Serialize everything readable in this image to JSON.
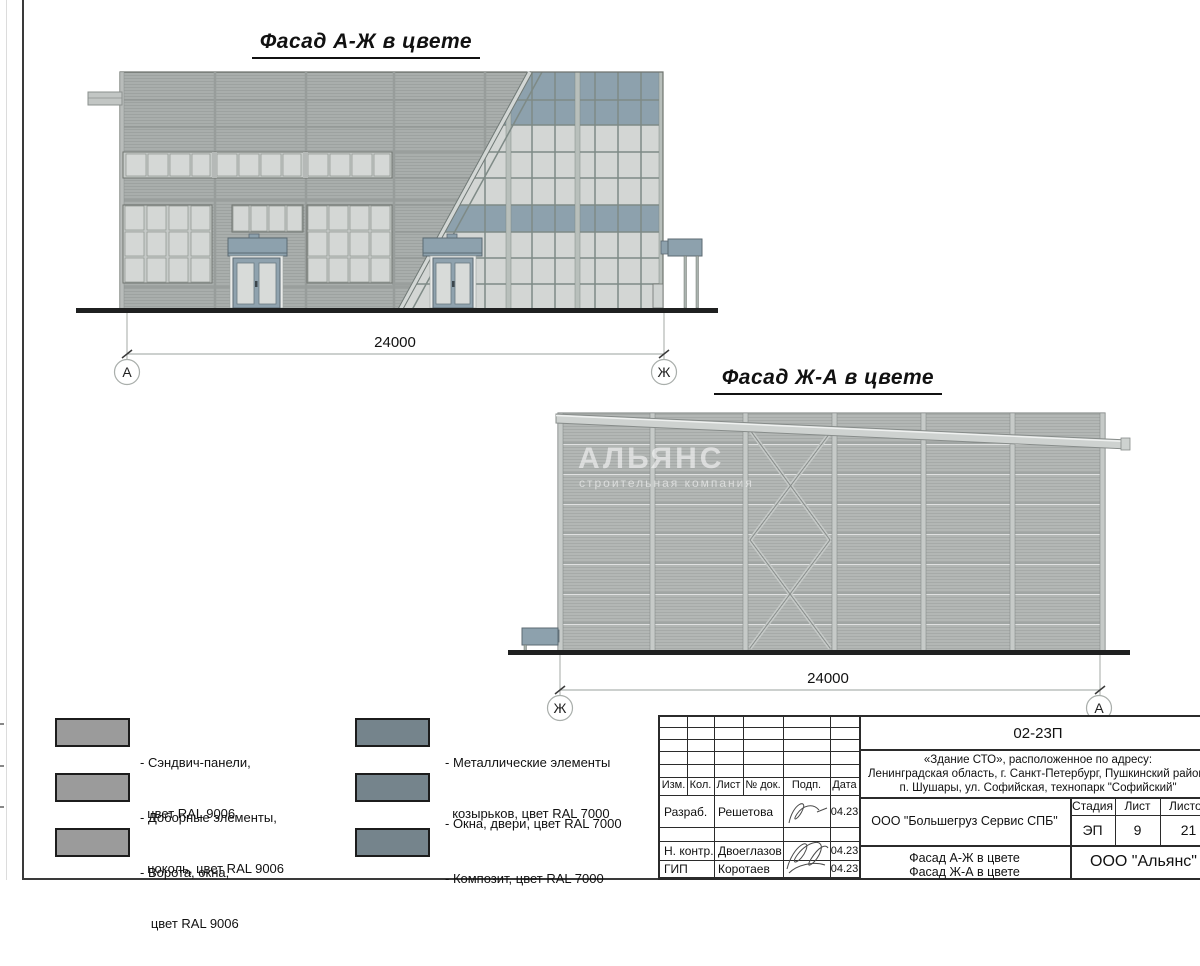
{
  "titles": {
    "facade_aj": "Фасад А-Ж в цвете",
    "facade_ja": "Фасад Ж-А в цвете"
  },
  "facade_aj": {
    "dim": "24000",
    "axis_left": "А",
    "axis_right": "Ж"
  },
  "facade_ja": {
    "dim": "24000",
    "axis_left": "Ж",
    "axis_right": "А"
  },
  "watermark": {
    "line1": "АЛЬЯНС",
    "line2": "строительная компания"
  },
  "legend": {
    "col1": [
      {
        "line1": "- Сэндвич-панели,",
        "line2": "  цвет RAL 9006"
      },
      {
        "line1": "- Доборные элементы,",
        "line2": "  цоколь, цвет RAL 9006"
      },
      {
        "line1": "- Ворота, окна,",
        "line2": "   цвет RAL 9006"
      }
    ],
    "col2": [
      {
        "line1": "- Металлические элементы",
        "line2": "  козырьков, цвет RAL 7000"
      },
      {
        "line1": "- Окна, двери, цвет RAL 7000",
        "line2": ""
      },
      {
        "line1": "- Композит, цвет RAL 7000",
        "line2": ""
      }
    ],
    "ral9006": "#9b9b9b",
    "ral7000": "#75848c"
  },
  "title_block": {
    "doc_number": "02-23П",
    "object_line1": "«Здание СТО», расположенное по адресу:",
    "object_line2": "Ленинградская область, г. Санкт-Петербург, Пушкинский район,",
    "object_line3": "п. Шушары, ул. Софийская, технопарк \"Софийский\"",
    "company": "ООО \"Большегруз Сервис СПБ\"",
    "sheet_name_line1": "Фасад А-Ж в цвете",
    "sheet_name_line2": "Фасад Ж-А в цвете",
    "org": "ООО \"Альянс\"",
    "stage_label": "Стадия",
    "sheet_label": "Лист",
    "sheets_label": "Листов",
    "stage_value": "ЭП",
    "sheet_value": "9",
    "sheets_value": "21",
    "col_headers": [
      "Изм.",
      "Кол.",
      "Лист",
      "№ док.",
      "Подп.",
      "Дата"
    ],
    "signature_rows": [
      {
        "role": "Разраб.",
        "name": "Решетова",
        "date": "04.23"
      },
      {
        "role": "Н. контр.",
        "name": "Двоеглазов",
        "date": "04.23"
      },
      {
        "role": "ГИП",
        "name": "Коротаев",
        "date": "04.23"
      }
    ]
  },
  "colors": {
    "panel_gray": "#a9aeac",
    "panel_light": "#b3b7b5",
    "spandrel_blue": "#8da1ad",
    "canopy_blue": "#8da1ad",
    "glass": "#d3d6d4",
    "ground": "#1f2020"
  }
}
